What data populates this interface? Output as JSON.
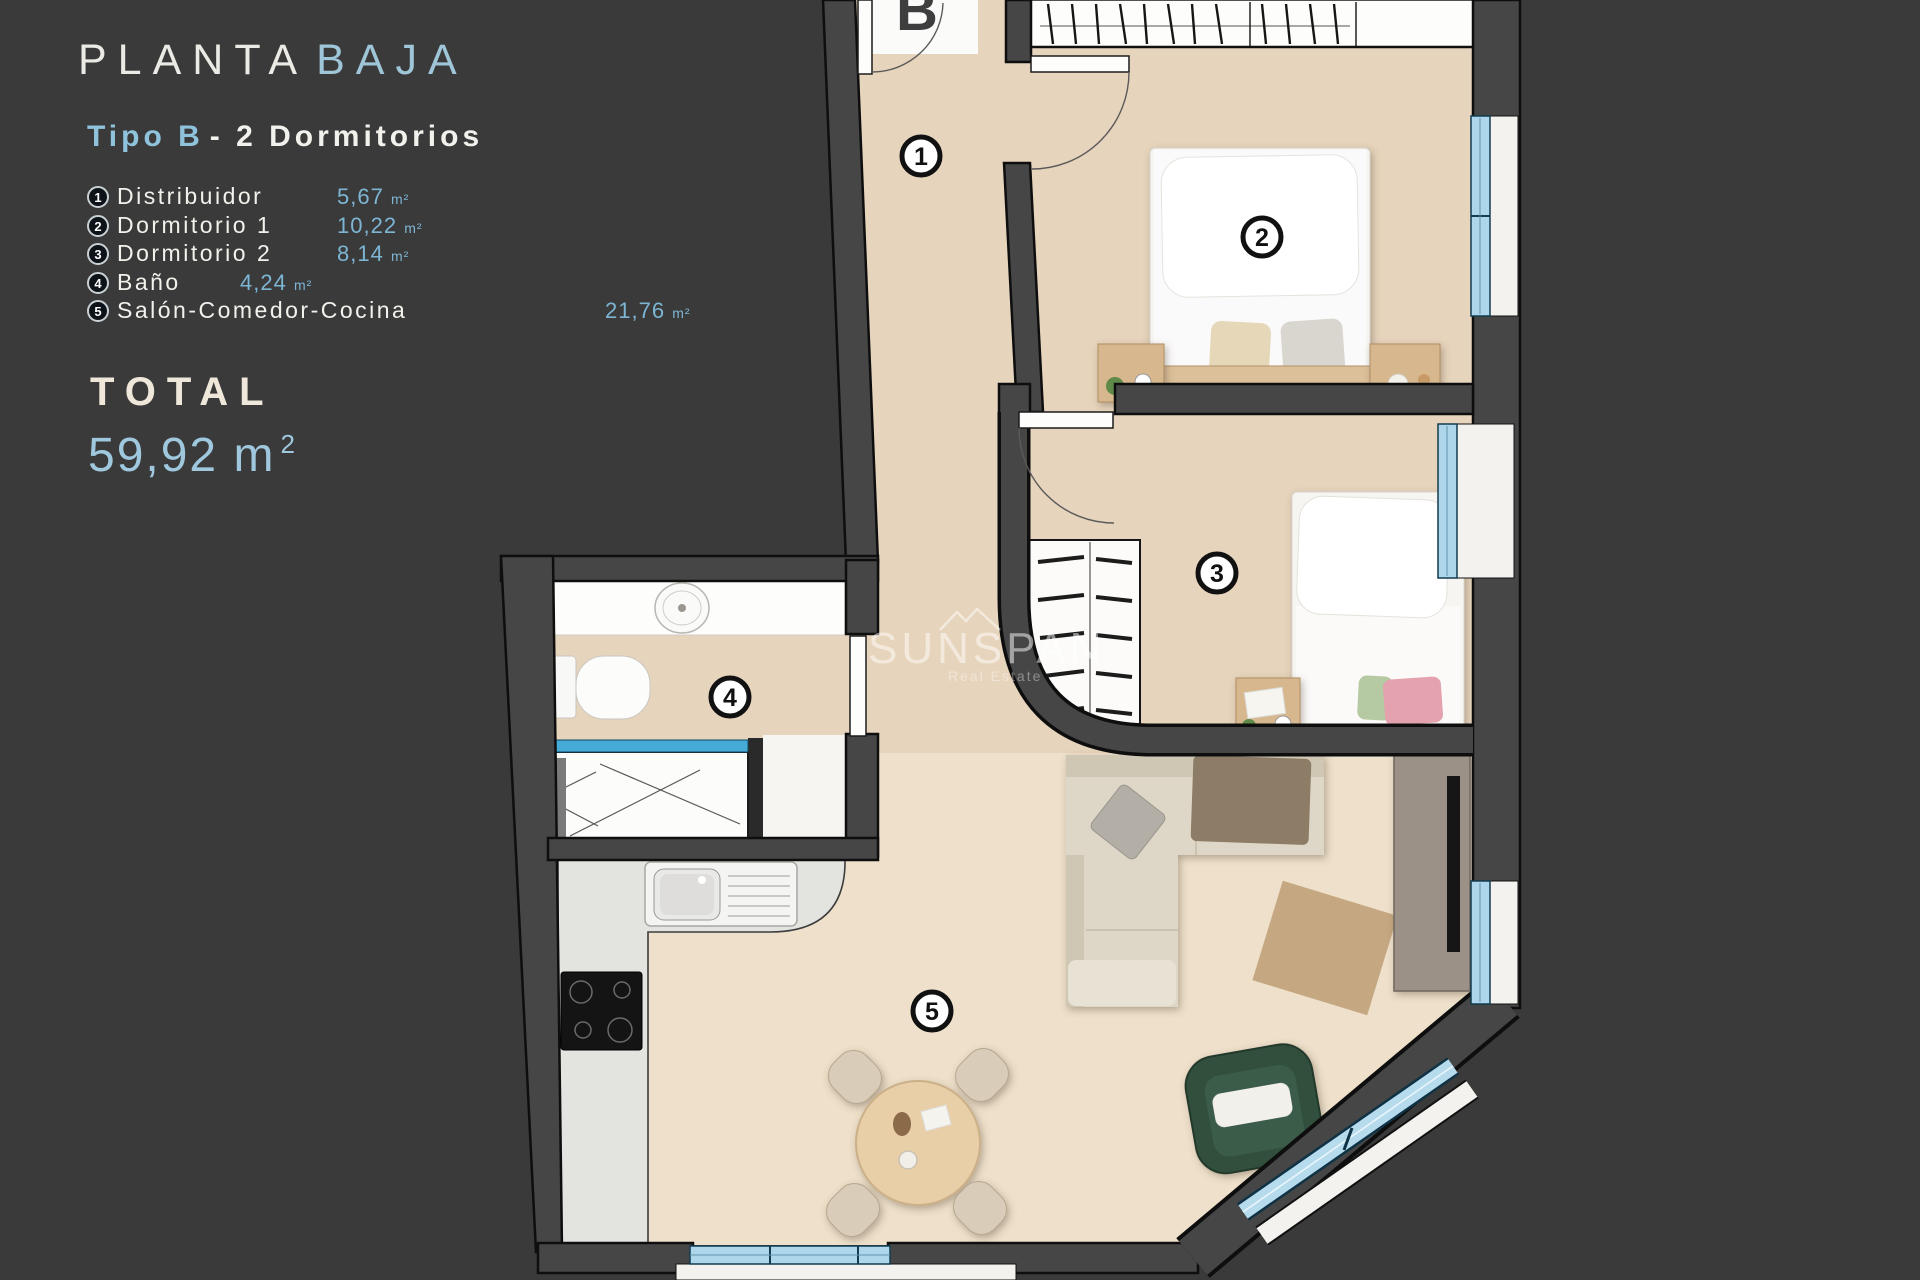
{
  "colors": {
    "background": "#3a3a3a",
    "accent_blue": "#8fc3dc",
    "value_blue": "#7db6d4",
    "text_white": "#f2f1ec",
    "total_cream": "#efe8da",
    "floor_beige": "#e7d4bc",
    "wall_gray": "#464646",
    "window_glass": "#aed6ea",
    "shower_glass": "#45aad6",
    "sofa_beige": "#ded7c7",
    "armchair_green": "#30503e",
    "wood": "#d7b88e"
  },
  "panel": {
    "title": {
      "part1": "PLANTA",
      "part2": "BAJA"
    },
    "subtitle": {
      "part1": "Tipo B",
      "part2": "- 2 Dormitorios"
    },
    "rooms": [
      {
        "num": "1",
        "name": "Distribuidor",
        "area": "5,67",
        "unit": "m²"
      },
      {
        "num": "2",
        "name": "Dormitorio 1",
        "area": "10,22",
        "unit": "m²"
      },
      {
        "num": "3",
        "name": "Dormitorio 2",
        "area": "8,14",
        "unit": "m²"
      },
      {
        "num": "4",
        "name": "Baño",
        "area": "4,24",
        "unit": "m²"
      },
      {
        "num": "5",
        "name": "Salón-Comedor-Cocina",
        "area": "21,76",
        "unit": "m²"
      }
    ],
    "total": {
      "label": "TOTAL",
      "value": "59,92",
      "unit": "m",
      "sup": "2"
    }
  },
  "plan": {
    "entrance_label": "B",
    "labels": [
      {
        "num": "1"
      },
      {
        "num": "2"
      },
      {
        "num": "3"
      },
      {
        "num": "4"
      },
      {
        "num": "5"
      }
    ]
  },
  "watermark": {
    "name": "SUNSPAN",
    "tagline": "Real Estate"
  }
}
